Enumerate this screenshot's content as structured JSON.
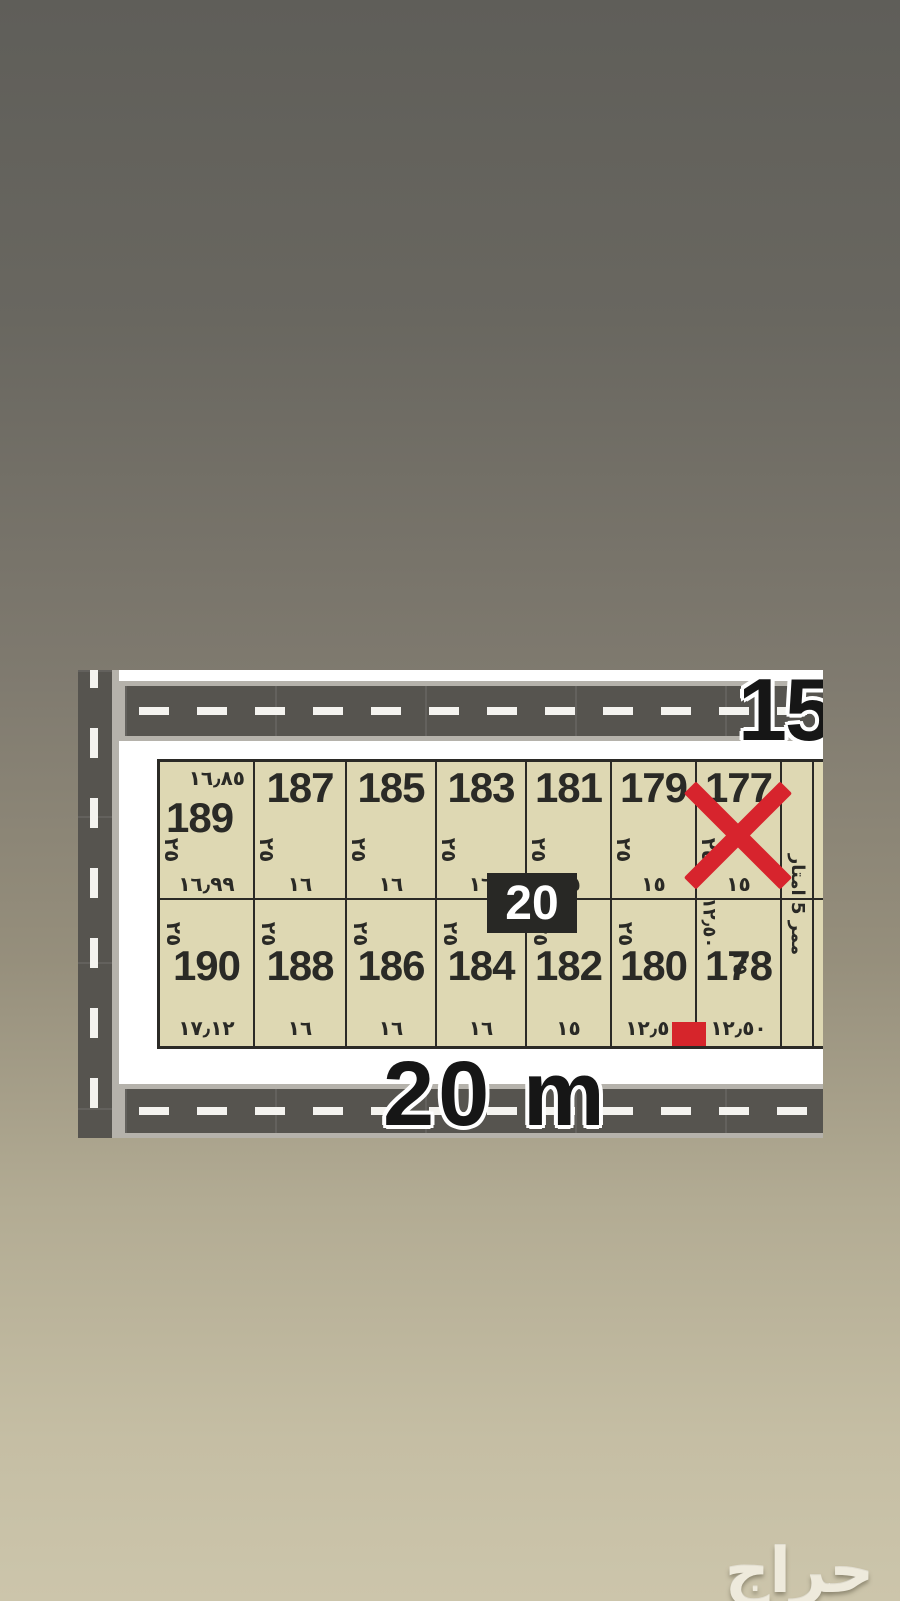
{
  "background": {
    "top_color": "#5f5e59",
    "bottom_color": "#ccc5ab"
  },
  "watermark": {
    "text": "حراج",
    "color": "#eeeadc"
  },
  "map": {
    "colors": {
      "asphalt": "#56544f",
      "road_edge": "#b5b2ab",
      "canvas": "#ffffff",
      "plot_fill": "#ded8b3",
      "plot_border": "#2b2a26",
      "red": "#d7242d",
      "badge_bg": "#282825"
    },
    "top_road": {
      "label": "15"
    },
    "bottom_road": {
      "label": "20 m"
    },
    "street_width_badge": "20",
    "walkway": {
      "label": "ممر 5 امتار"
    },
    "markers": {
      "crossed_out_plot": "177",
      "red_rect_between_plots": "180/178"
    },
    "rows": [
      {
        "plots": [
          {
            "number": "189",
            "top_dim": "١٦٫٨٥",
            "side_dim": "٢٥",
            "bottom_dim": "١٦٫٩٩"
          },
          {
            "number": "187",
            "side_dim": "٢٥",
            "bottom_dim": "١٦"
          },
          {
            "number": "185",
            "side_dim": "٢٥",
            "bottom_dim": "١٦"
          },
          {
            "number": "183",
            "side_dim": "٢٥",
            "bottom_dim": "١٦"
          },
          {
            "number": "181",
            "side_dim": "٢٥",
            "bottom_dim": "١٥"
          },
          {
            "number": "179",
            "side_dim": "٢٥",
            "bottom_dim": "١٥"
          },
          {
            "number": "177",
            "side_dim": "٢٥",
            "bottom_dim": "١٥",
            "crossed_out": true
          }
        ]
      },
      {
        "plots": [
          {
            "number": "190",
            "side_dim": "٢٥",
            "bottom_dim": "١٧٫١٢"
          },
          {
            "number": "188",
            "side_dim": "٢٥",
            "bottom_dim": "١٦"
          },
          {
            "number": "186",
            "side_dim": "٢٥",
            "bottom_dim": "١٦"
          },
          {
            "number": "184",
            "side_dim": "٢٥",
            "bottom_dim": "١٦"
          },
          {
            "number": "182",
            "side_dim": "٢٥",
            "bottom_dim": "١٥"
          },
          {
            "number": "180",
            "side_dim": "٢٥",
            "bottom_dim": "١٢٫٥٠"
          },
          {
            "number": "178",
            "side_dim": "٢٥",
            "side_dim_position": "right",
            "left_dim": "١٢٫٥٠",
            "bottom_dim": "١٢٫٥٠",
            "red_marker": true
          }
        ]
      }
    ]
  }
}
